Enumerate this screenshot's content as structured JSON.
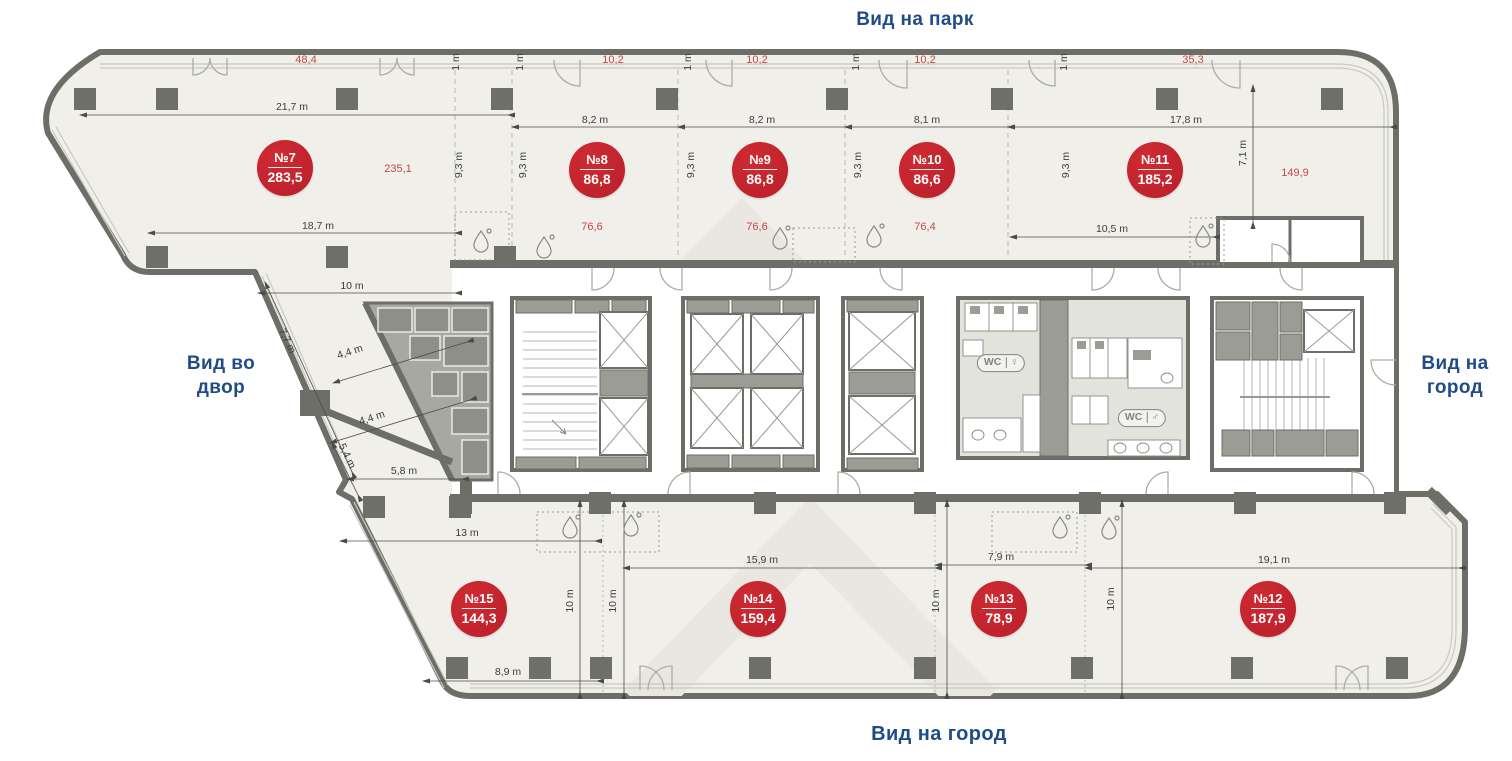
{
  "view_labels": {
    "top": "Вид на парк",
    "left": [
      "Вид во",
      "двор"
    ],
    "right": [
      "Вид на",
      "город"
    ],
    "bottom": "Вид на город"
  },
  "units": [
    {
      "number": "№7",
      "area": "283,5",
      "x": 285,
      "y": 168
    },
    {
      "number": "№8",
      "area": "86,8",
      "x": 597,
      "y": 170
    },
    {
      "number": "№9",
      "area": "86,8",
      "x": 760,
      "y": 170
    },
    {
      "number": "№10",
      "area": "86,6",
      "x": 927,
      "y": 170
    },
    {
      "number": "№11",
      "area": "185,2",
      "x": 1155,
      "y": 170
    },
    {
      "number": "№12",
      "area": "187,9",
      "x": 1268,
      "y": 609
    },
    {
      "number": "№13",
      "area": "78,9",
      "x": 999,
      "y": 609
    },
    {
      "number": "№14",
      "area": "159,4",
      "x": 758,
      "y": 609
    },
    {
      "number": "№15",
      "area": "144,3",
      "x": 479,
      "y": 609
    }
  ],
  "red_area_labels": [
    {
      "text": "48,4",
      "x": 306,
      "y": 60
    },
    {
      "text": "10,2",
      "x": 613,
      "y": 60
    },
    {
      "text": "10,2",
      "x": 757,
      "y": 60
    },
    {
      "text": "10,2",
      "x": 925,
      "y": 60
    },
    {
      "text": "35,3",
      "x": 1193,
      "y": 60
    },
    {
      "text": "235,1",
      "x": 398,
      "y": 169
    },
    {
      "text": "149,9",
      "x": 1295,
      "y": 173
    },
    {
      "text": "76,6",
      "x": 592,
      "y": 227
    },
    {
      "text": "76,6",
      "x": 757,
      "y": 227
    },
    {
      "text": "76,4",
      "x": 925,
      "y": 227
    }
  ],
  "dimensions": [
    {
      "text": "21,7 m",
      "x": 292,
      "y": 107,
      "r": 0
    },
    {
      "text": "8,2 m",
      "x": 595,
      "y": 120,
      "r": 0
    },
    {
      "text": "8,2 m",
      "x": 762,
      "y": 120,
      "r": 0
    },
    {
      "text": "8,1 m",
      "x": 927,
      "y": 120,
      "r": 0
    },
    {
      "text": "17,8 m",
      "x": 1186,
      "y": 120,
      "r": 0
    },
    {
      "text": "18,7 m",
      "x": 318,
      "y": 226,
      "r": 0
    },
    {
      "text": "10,5 m",
      "x": 1112,
      "y": 229,
      "r": 0
    },
    {
      "text": "10 m",
      "x": 352,
      "y": 286,
      "r": 0
    },
    {
      "text": "5,8 m",
      "x": 404,
      "y": 471,
      "r": 0
    },
    {
      "text": "13 m",
      "x": 467,
      "y": 533,
      "r": 0
    },
    {
      "text": "8,9 m",
      "x": 508,
      "y": 672,
      "r": 0
    },
    {
      "text": "15,9 m",
      "x": 762,
      "y": 560,
      "r": 0
    },
    {
      "text": "7,9 m",
      "x": 1001,
      "y": 557,
      "r": 0
    },
    {
      "text": "19,1 m",
      "x": 1274,
      "y": 560,
      "r": 0
    },
    {
      "text": "1 m",
      "x": 456,
      "y": 62,
      "r": -90
    },
    {
      "text": "1 m",
      "x": 520,
      "y": 62,
      "r": -90
    },
    {
      "text": "1 m",
      "x": 688,
      "y": 62,
      "r": -90
    },
    {
      "text": "1 m",
      "x": 856,
      "y": 62,
      "r": -90
    },
    {
      "text": "1 m",
      "x": 1064,
      "y": 62,
      "r": -90
    },
    {
      "text": "9,3 m",
      "x": 459,
      "y": 165,
      "r": -90
    },
    {
      "text": "9,3 m",
      "x": 523,
      "y": 165,
      "r": -90
    },
    {
      "text": "9,3 m",
      "x": 691,
      "y": 165,
      "r": -90
    },
    {
      "text": "9,3 m",
      "x": 858,
      "y": 165,
      "r": -90
    },
    {
      "text": "9,3 m",
      "x": 1066,
      "y": 165,
      "r": -90
    },
    {
      "text": "7,1 m",
      "x": 1243,
      "y": 153,
      "r": -90
    },
    {
      "text": "7,7 m",
      "x": 287,
      "y": 341,
      "r": 64
    },
    {
      "text": "4,4 m",
      "x": 350,
      "y": 352,
      "r": -18
    },
    {
      "text": "4,4 m",
      "x": 372,
      "y": 418,
      "r": -18
    },
    {
      "text": "5,4 m",
      "x": 347,
      "y": 456,
      "r": 64
    },
    {
      "text": "10 m",
      "x": 570,
      "y": 601,
      "r": -90
    },
    {
      "text": "10 m",
      "x": 613,
      "y": 601,
      "r": -90
    },
    {
      "text": "10 m",
      "x": 936,
      "y": 601,
      "r": -90
    },
    {
      "text": "10 m",
      "x": 1111,
      "y": 599,
      "r": -90
    }
  ],
  "wc_signs": [
    {
      "label": "WC",
      "icon": "female-icon",
      "glyph": "♀",
      "x": 1001,
      "y": 363
    },
    {
      "label": "WC",
      "icon": "male-icon",
      "glyph": "♂",
      "x": 1142,
      "y": 418
    }
  ],
  "colors": {
    "accent_blue": "#1f4c87",
    "badge_red": "#c2232e",
    "dim_red": "#c14a48",
    "dim_black": "#3c3c3c",
    "plan_fill": "#f0efe9",
    "wall": "#6e6e69"
  }
}
